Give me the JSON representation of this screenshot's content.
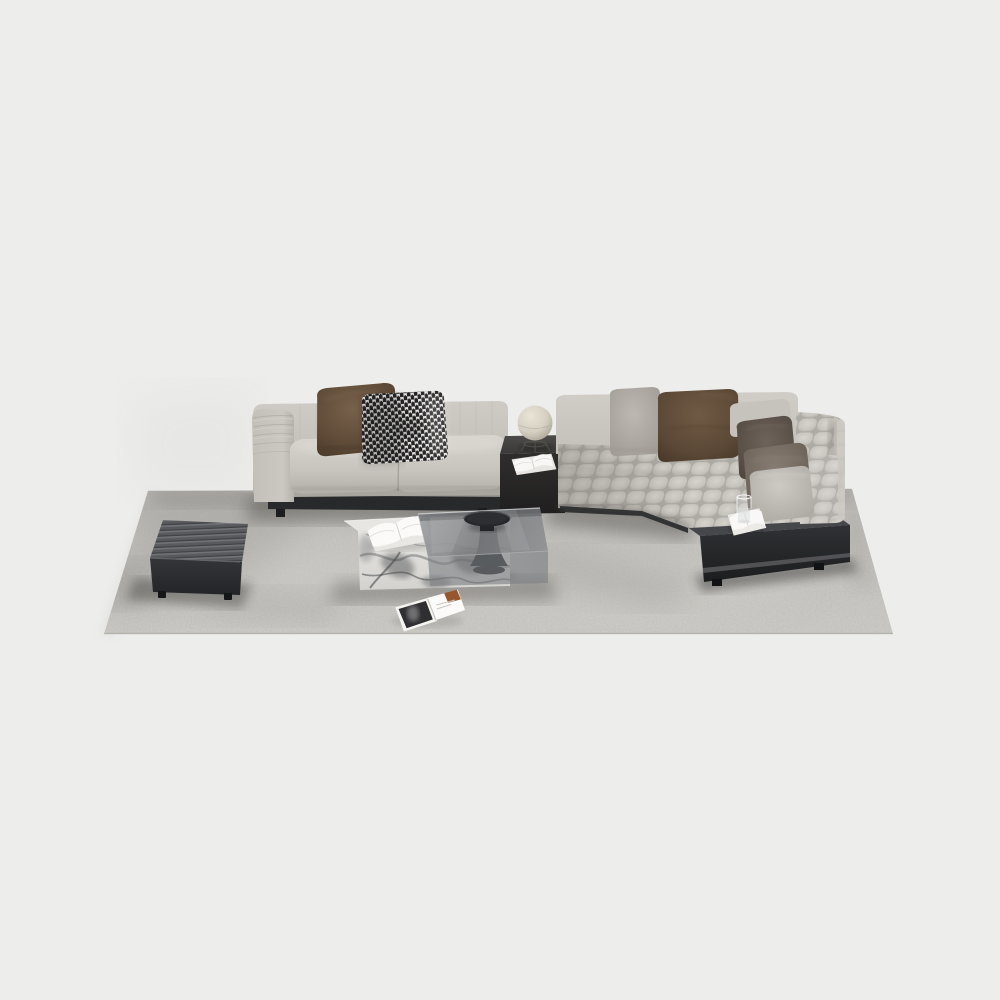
{
  "scene": {
    "type": "3d-furniture-render",
    "description": "Modern minimalist living room furniture set on a light gray rug: a three-seat sofa and an L-shaped sectional with black shelf base, marble and smoked-glass coffee table, channel-tufted leather ottoman, black cube side table with a sphere lamp, open books and a magazine",
    "background": "#ededec"
  },
  "palette": {
    "background": "#ededec",
    "rug": "#c7c5c1",
    "rug_shadow": "#b4b2ae",
    "sofa_fabric": "#c8c5bf",
    "sofa_fabric_highlight": "#d7d4ce",
    "sofa_fabric_shadow": "#aaa7a1",
    "base_black": "#28292b",
    "ottoman_top": "#54565a",
    "ottoman_front": "#2d2e30",
    "pillow_brown": "#5f4b38",
    "pillow_gray": "#b2ada7",
    "pillow_taupe": "#7d7369",
    "pillow_dark_taupe": "#5c5248",
    "houndstooth_dark": "#232325",
    "houndstooth_light": "#e7e5e1",
    "marble_white": "#e7e6e3",
    "marble_vein": "#4a4b4f",
    "glass_smoke": "#7d7f82",
    "sphere_lamp": "#ddd7ca",
    "magazine_accent": "#96562e"
  },
  "objects": {
    "rug": {
      "label": "area rug"
    },
    "sofa_left": {
      "label": "three-seat modular sofa",
      "pillows": [
        "brown leather pillow",
        "houndstooth pillow"
      ]
    },
    "sofa_right": {
      "label": "L-shaped sectional sofa with chaise on black shelf base",
      "pillows": [
        "gray pillow",
        "brown pillow",
        "light back cushion",
        "dark taupe pillow",
        "taupe velvet pillow",
        "light chaise pillow"
      ],
      "shelf_items": [
        "open book",
        "water glass"
      ]
    },
    "side_table": {
      "label": "black cube side table",
      "items": [
        "sphere table lamp",
        "open book"
      ]
    },
    "coffee_table": {
      "label": "marble block coffee table with smoked glass top",
      "items": [
        "open book",
        "black pedestal side table"
      ]
    },
    "ottoman": {
      "label": "channel-tufted leather ottoman"
    },
    "magazine": {
      "label": "open magazine lying on rug"
    }
  }
}
